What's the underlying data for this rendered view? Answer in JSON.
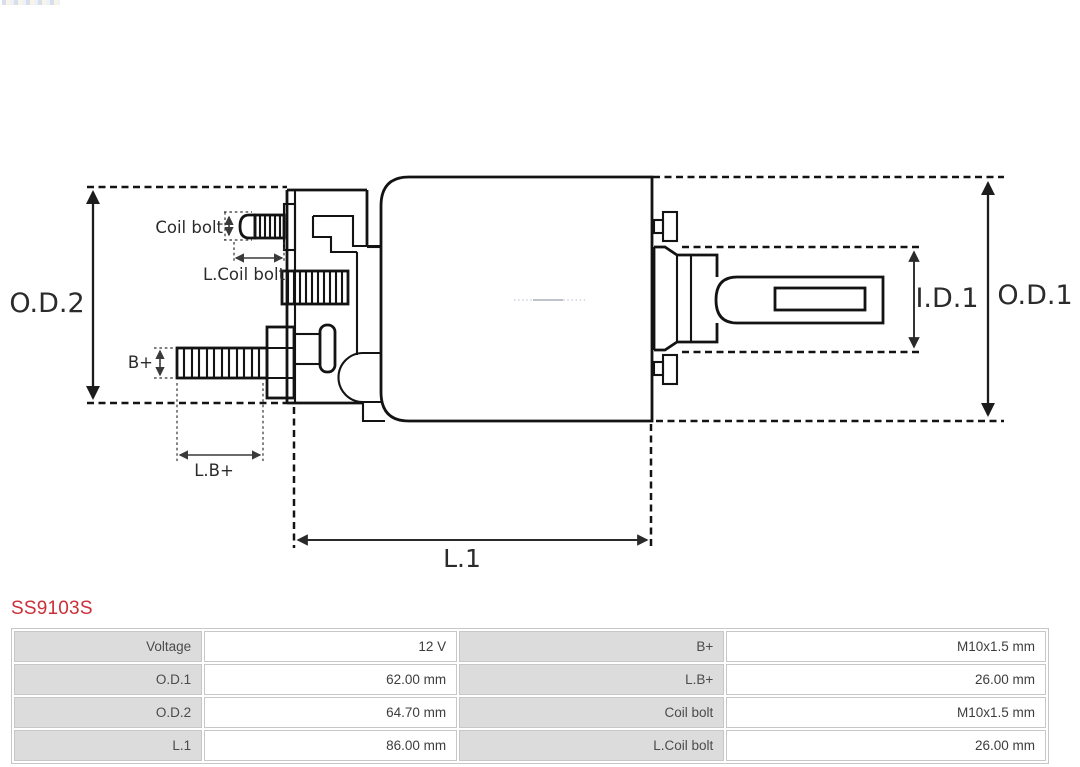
{
  "part_number": "SS9103S",
  "diagram": {
    "labels": {
      "od2": "O.D.2",
      "od1": "O.D.1",
      "id1": "I.D.1",
      "l1": "L.1",
      "coil_bolt": "Coil bolt",
      "l_coil_bolt": "L.Coil bolt",
      "b_plus": "B+",
      "l_b_plus": "L.B+"
    }
  },
  "colors": {
    "part_number_red": "#cb3038",
    "table_label_bg": "#dcdcdc",
    "table_border": "#c7c7c7",
    "drawing_stroke": "#131313"
  },
  "spec_table": {
    "rows": [
      {
        "label_left": "Voltage",
        "value_left": "12 V",
        "label_right": "B+",
        "value_right": "M10x1.5 mm"
      },
      {
        "label_left": "O.D.1",
        "value_left": "62.00 mm",
        "label_right": "L.B+",
        "value_right": "26.00 mm"
      },
      {
        "label_left": "O.D.2",
        "value_left": "64.70 mm",
        "label_right": "Coil bolt",
        "value_right": "M10x1.5 mm"
      },
      {
        "label_left": "L.1",
        "value_left": "86.00 mm",
        "label_right": "L.Coil bolt",
        "value_right": "26.00 mm"
      }
    ]
  }
}
